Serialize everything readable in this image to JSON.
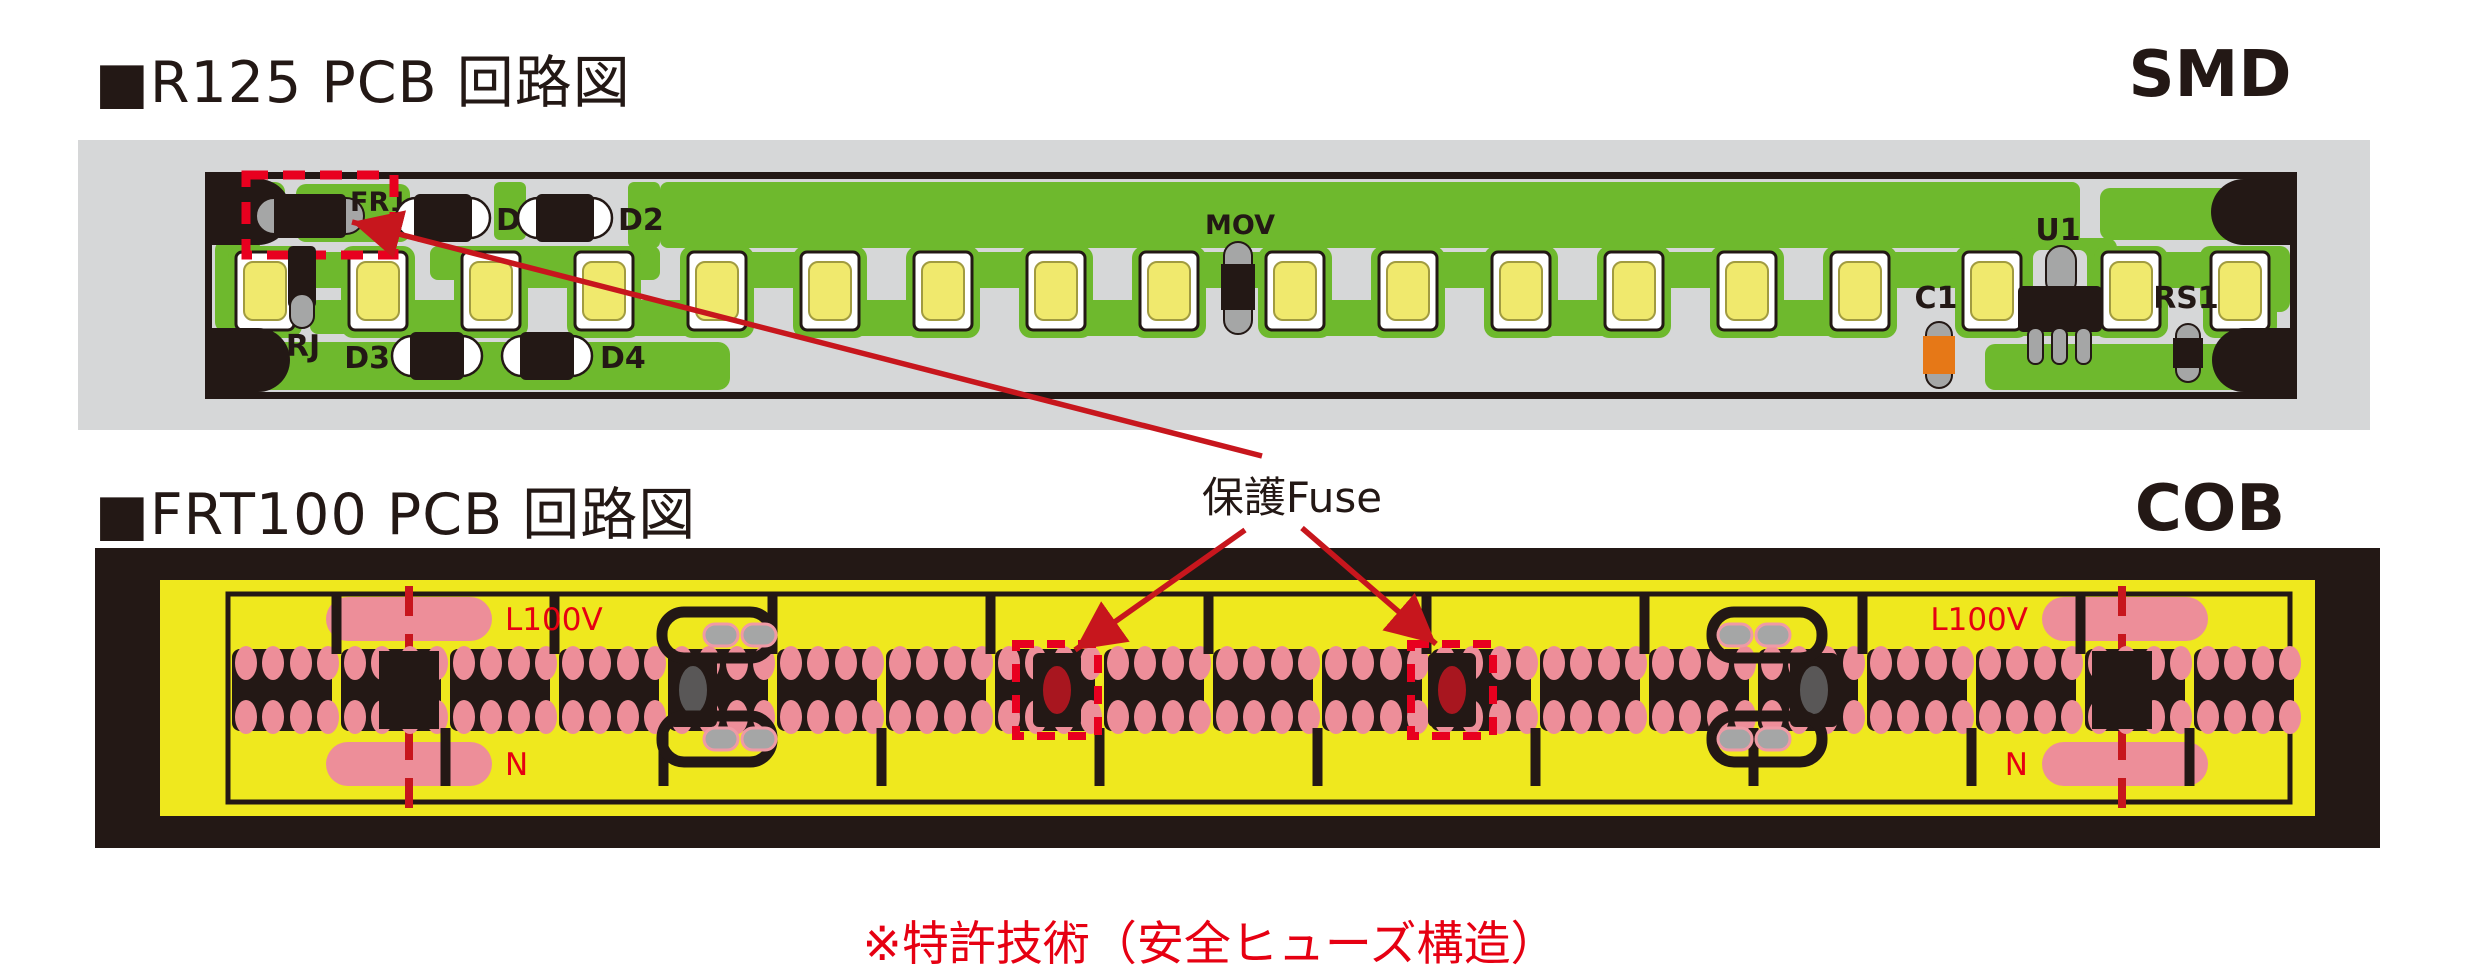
{
  "titles": {
    "smd_section": "■R125 PCB 回路図",
    "smd_type": "SMD",
    "cob_section": "■FRT100 PCB 回路図",
    "cob_type": "COB"
  },
  "annotation": {
    "fuse_label": "保護Fuse",
    "note": "※特許技術（安全ヒューズ構造）"
  },
  "smd_board": {
    "labels": {
      "fr1": "FR1",
      "d1": "D1",
      "d2": "D2",
      "d3": "D3",
      "d4": "D4",
      "rj": "RJ",
      "mov": "MOV",
      "u1": "U1",
      "c1": "C1",
      "rs1": "RS1"
    },
    "led_count": 18,
    "led_centers": [
      265,
      378,
      491,
      604,
      717,
      830,
      943,
      1056,
      1169,
      1295,
      1408,
      1521,
      1634,
      1747,
      1860,
      1992,
      2131,
      2240
    ]
  },
  "cob_board": {
    "labels": {
      "l_left": "L100V",
      "n_left": "N",
      "l_right": "L100V",
      "n_right": "N"
    },
    "band": {
      "start": 232,
      "pitch": 109,
      "count": 19,
      "module_width": 100,
      "y": 649,
      "height": 82
    },
    "junction_squares": [
      409,
      2122
    ],
    "fuses_gray": [
      693,
      1814
    ],
    "fuses_highlighted": [
      1057,
      1452
    ]
  },
  "colors": {
    "text_dark": "#231815",
    "red_accent": "#e60012",
    "arrow_red": "#c7161d",
    "dashed_red": "#e8001f",
    "board_gray": "#d6d7d8",
    "trace_green": "#6eb92d",
    "led_yellow": "#f0e96d",
    "component_black": "#231815",
    "cap_gray": "#a5a6a6",
    "cap_orange": "#e67817",
    "cob_yellow": "#efe81e",
    "pad_pink": "#ed8e99",
    "fuse_gray": "#595757",
    "fuse_dark_red": "#a8161f"
  }
}
